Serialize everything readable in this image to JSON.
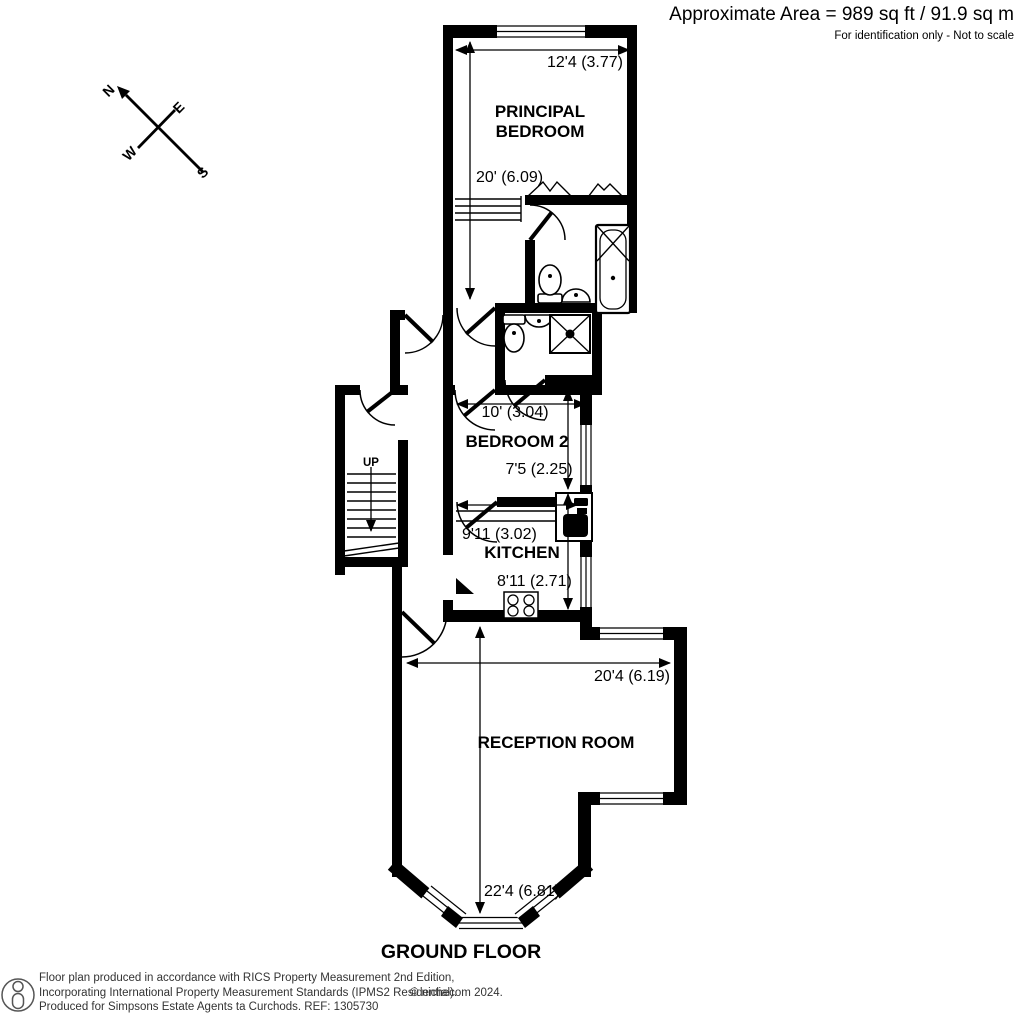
{
  "header": {
    "approx_area": "Approximate Area = 989 sq ft / 91.9 sq m",
    "disclaimer": "For identification only - Not to scale"
  },
  "compass": {
    "north": "N",
    "east": "E",
    "south": "S",
    "west": "W"
  },
  "rooms": {
    "principal_bedroom": {
      "name_line1": "PRINCIPAL",
      "name_line2": "BEDROOM",
      "dim_width": "12'4 (3.77)",
      "dim_length": "20' (6.09)"
    },
    "bedroom2": {
      "name": "BEDROOM 2",
      "dim_width": "10' (3.04)",
      "dim_length": "7'5 (2.25)"
    },
    "kitchen": {
      "name": "KITCHEN",
      "dim_width": "9'11 (3.02)",
      "dim_length": "8'11 (2.71)"
    },
    "reception": {
      "name": "RECEPTION ROOM",
      "dim_width": "20'4 (6.19)",
      "dim_length": "22'4 (6.81)"
    },
    "stairs": {
      "direction": "UP"
    }
  },
  "floor_title": "GROUND FLOOR",
  "footer": {
    "line1": "Floor plan produced in accordance with RICS Property Measurement 2nd Edition,",
    "line2": "Incorporating International Property Measurement Standards (IPMS2 Residential).",
    "copyright": "© nichecom 2024.",
    "line3": "Produced for Simpsons Estate Agents ta Curchods.   REF: 1305730"
  },
  "colors": {
    "wall": "#000000",
    "text": "#000000",
    "footer_text": "#333333"
  }
}
